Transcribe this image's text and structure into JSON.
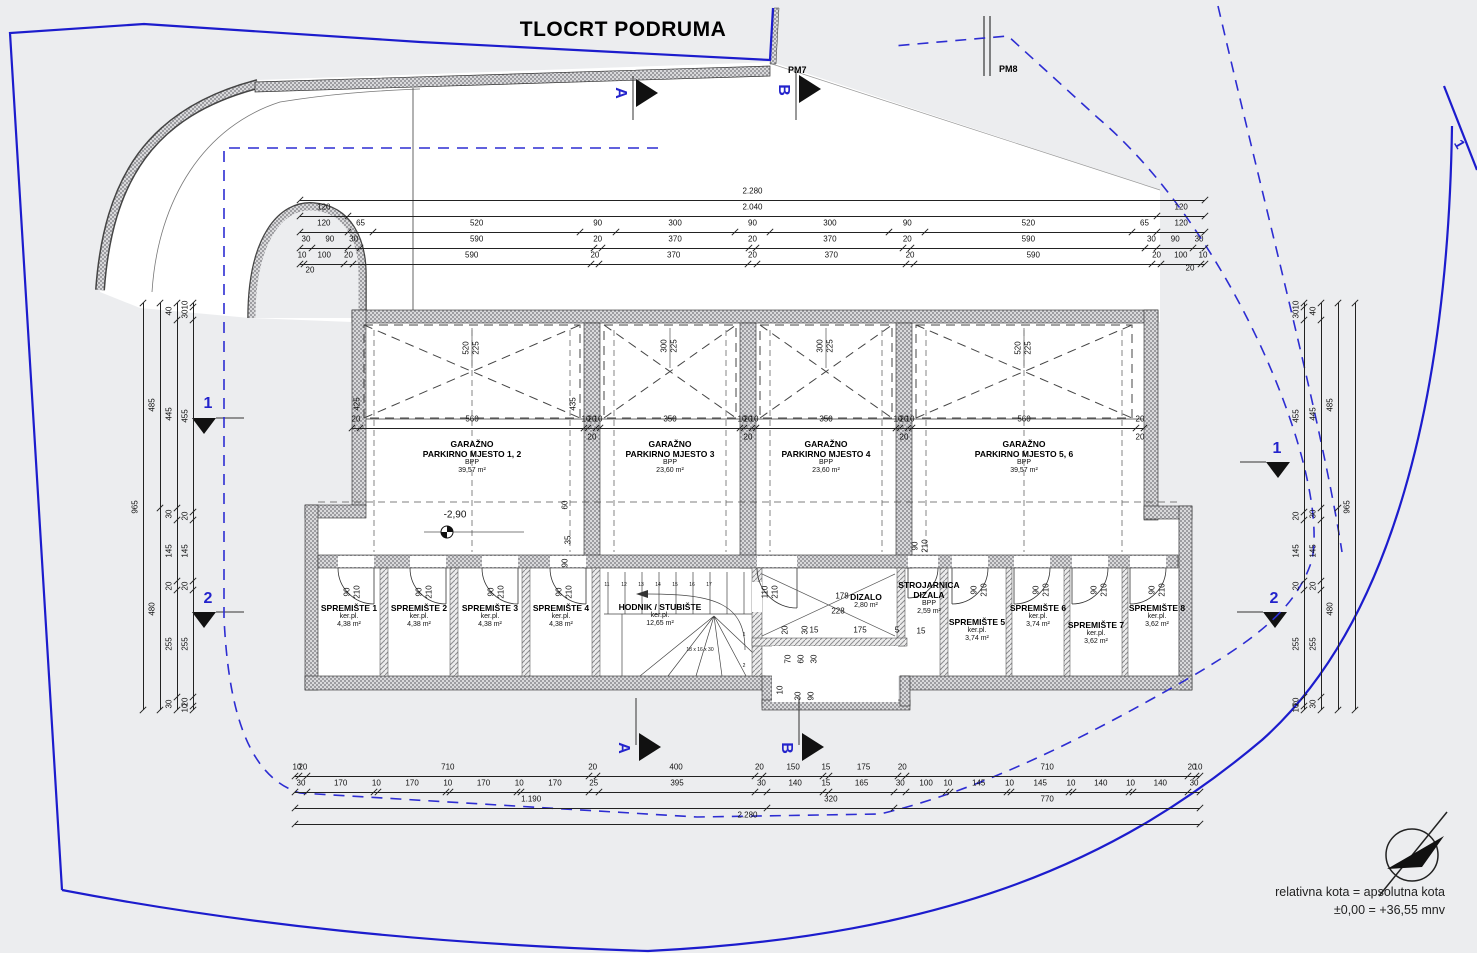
{
  "title": "TLOCRT PODRUMA",
  "legend": {
    "line1": "relativna kota = apsolutna kota",
    "line2": "±0,00 = +36,55 mnv"
  },
  "labels": {
    "pm7": "PM7",
    "pm8": "PM8",
    "corner_plot": "1"
  },
  "colors": {
    "boundary": "#1c1ccd",
    "setback": "#2d2dd2",
    "bg": "#ecedef",
    "ink": "#1a1a1a"
  },
  "rooms": [
    {
      "id": "garage-1-2",
      "name": "GARAŽNO\nPARKIRNO MJESTO 1, 2",
      "sub1": "BPP",
      "sub2": "39,57 m²",
      "cx": 472,
      "cy": 447
    },
    {
      "id": "garage-3",
      "name": "GARAŽNO\nPARKIRNO MJESTO 3",
      "sub1": "BPP",
      "sub2": "23,60 m²",
      "cx": 670,
      "cy": 447
    },
    {
      "id": "garage-4",
      "name": "GARAŽNO\nPARKIRNO MJESTO 4",
      "sub1": "BPP",
      "sub2": "23,60 m²",
      "cx": 826,
      "cy": 447
    },
    {
      "id": "garage-5-6",
      "name": "GARAŽNO\nPARKIRNO MJESTO 5, 6",
      "sub1": "BPP",
      "sub2": "39,57 m²",
      "cx": 1024,
      "cy": 447
    },
    {
      "id": "spremiste-1",
      "name": "SPREMIŠTE 1",
      "sub1": "ker.pl.",
      "sub2": "4,38 m²",
      "cx": 349,
      "cy": 611
    },
    {
      "id": "spremiste-2",
      "name": "SPREMIŠTE 2",
      "sub1": "ker.pl.",
      "sub2": "4,38 m²",
      "cx": 419,
      "cy": 611
    },
    {
      "id": "spremiste-3",
      "name": "SPREMIŠTE 3",
      "sub1": "ker.pl.",
      "sub2": "4,38 m²",
      "cx": 490,
      "cy": 611
    },
    {
      "id": "spremiste-4",
      "name": "SPREMIŠTE 4",
      "sub1": "ker.pl.",
      "sub2": "4,38 m²",
      "cx": 561,
      "cy": 611
    },
    {
      "id": "hodnik-stubiste",
      "name": "HODNIK / STUBIŠTE",
      "sub1": "ker.pl.",
      "sub2": "12,65 m²",
      "cx": 660,
      "cy": 610
    },
    {
      "id": "dizalo",
      "name": "DIZALO",
      "sub1": "2,80 m²",
      "sub2": "",
      "cx": 866,
      "cy": 600
    },
    {
      "id": "strojarnica-dizala",
      "name": "STROJARNICA\nDIZALA",
      "sub1": "BPP",
      "sub2": "2,59 m²",
      "cx": 929,
      "cy": 588
    },
    {
      "id": "spremiste-5",
      "name": "SPREMIŠTE 5",
      "sub1": "ker.pl.",
      "sub2": "3,74 m²",
      "cx": 977,
      "cy": 625
    },
    {
      "id": "spremiste-6",
      "name": "SPREMIŠTE 6",
      "sub1": "ker.pl.",
      "sub2": "3,74 m²",
      "cx": 1038,
      "cy": 611
    },
    {
      "id": "spremiste-7",
      "name": "SPREMIŠTE 7",
      "sub1": "ker.pl.",
      "sub2": "3,62 m²",
      "cx": 1096,
      "cy": 628
    },
    {
      "id": "spremiste-8",
      "name": "SPREMIŠTE 8",
      "sub1": "ker.pl.",
      "sub2": "3,62 m²",
      "cx": 1157,
      "cy": 611
    }
  ],
  "dims": {
    "chains": [
      {
        "id": "top-1",
        "o": "h",
        "x": 300,
        "y": 192,
        "len": 905,
        "vals": [
          "2.280"
        ]
      },
      {
        "id": "top-2",
        "o": "h",
        "x": 300,
        "y": 208,
        "len": 905,
        "vals": [
          "120",
          "2.040",
          "120"
        ]
      },
      {
        "id": "top-3",
        "o": "h",
        "x": 300,
        "y": 224,
        "len": 905,
        "vals": [
          "120",
          "65",
          "520",
          "90",
          "300",
          "90",
          "300",
          "90",
          "520",
          "65",
          "120"
        ]
      },
      {
        "id": "top-4",
        "o": "h",
        "x": 300,
        "y": 240,
        "len": 905,
        "vals": [
          "30",
          "90",
          "30",
          "590",
          "20",
          "370",
          "20",
          "370",
          "20",
          "590",
          "30",
          "90",
          "30"
        ]
      },
      {
        "id": "top-5",
        "o": "h",
        "x": 300,
        "y": 256,
        "len": 905,
        "vals": [
          "10",
          "100",
          "20",
          "590",
          "20",
          "370",
          "20",
          "370",
          "20",
          "590",
          "20",
          "100",
          "10"
        ]
      },
      {
        "id": "garage-front",
        "o": "h",
        "x": 352,
        "y": 420,
        "len": 792,
        "vals": [
          "20",
          "560",
          "10",
          "20",
          "10",
          "350",
          "10",
          "20",
          "10",
          "350",
          "10",
          "20",
          "10",
          "560",
          "20"
        ]
      },
      {
        "id": "bottom-1",
        "o": "h",
        "x": 295,
        "y": 768,
        "len": 905,
        "vals": [
          "10",
          "20",
          "710",
          "20",
          "400",
          "20",
          "150",
          "15",
          "175",
          "20",
          "710",
          "20",
          "10"
        ]
      },
      {
        "id": "bottom-2",
        "o": "h",
        "x": 295,
        "y": 784,
        "len": 905,
        "vals": [
          "30",
          "170",
          "10",
          "170",
          "10",
          "170",
          "10",
          "170",
          "25",
          "395",
          "30",
          "140",
          "15",
          "165",
          "30",
          "100",
          "10",
          "145",
          "10",
          "145",
          "10",
          "140",
          "10",
          "140",
          "30"
        ]
      },
      {
        "id": "bottom-3",
        "o": "h",
        "x": 295,
        "y": 800,
        "len": 905,
        "vals": [
          "1.190",
          "320",
          "770"
        ]
      },
      {
        "id": "bottom-4",
        "o": "h",
        "x": 295,
        "y": 816,
        "len": 905,
        "vals": [
          "2.280"
        ]
      },
      {
        "id": "left-1",
        "o": "v",
        "x": 143,
        "y": 303,
        "len": 407,
        "vals": [
          "965"
        ]
      },
      {
        "id": "left-2",
        "o": "v",
        "x": 160,
        "y": 303,
        "len": 407,
        "vals": [
          "485",
          "480"
        ]
      },
      {
        "id": "left-3",
        "o": "v",
        "x": 177,
        "y": 303,
        "len": 407,
        "vals": [
          "40",
          "445",
          "30",
          "145",
          "20",
          "255",
          "30"
        ]
      },
      {
        "id": "left-4",
        "o": "v",
        "x": 193,
        "y": 303,
        "len": 407,
        "vals": [
          "10",
          "30",
          "455",
          "20",
          "145",
          "20",
          "255",
          "20",
          "10"
        ]
      },
      {
        "id": "right-1",
        "o": "v",
        "x": 1304,
        "y": 303,
        "len": 407,
        "vals": [
          "10",
          "30",
          "455",
          "20",
          "145",
          "20",
          "255",
          "20",
          "10"
        ]
      },
      {
        "id": "right-2",
        "o": "v",
        "x": 1321,
        "y": 303,
        "len": 407,
        "vals": [
          "40",
          "445",
          "30",
          "145",
          "20",
          "255",
          "30"
        ]
      },
      {
        "id": "right-3",
        "o": "v",
        "x": 1338,
        "y": 303,
        "len": 407,
        "vals": [
          "485",
          "480"
        ]
      },
      {
        "id": "right-4",
        "o": "v",
        "x": 1355,
        "y": 303,
        "len": 407,
        "vals": [
          "965"
        ]
      }
    ]
  },
  "annotations": [
    {
      "t": "520",
      "x": 467,
      "y": 348,
      "r": -90
    },
    {
      "t": "225",
      "x": 477,
      "y": 348,
      "r": -90
    },
    {
      "t": "300",
      "x": 665,
      "y": 346,
      "r": -90
    },
    {
      "t": "225",
      "x": 675,
      "y": 346,
      "r": -90
    },
    {
      "t": "300",
      "x": 821,
      "y": 346,
      "r": -90
    },
    {
      "t": "225",
      "x": 831,
      "y": 346,
      "r": -90
    },
    {
      "t": "520",
      "x": 1019,
      "y": 348,
      "r": -90
    },
    {
      "t": "225",
      "x": 1029,
      "y": 348,
      "r": -90
    },
    {
      "t": "425",
      "x": 358,
      "y": 404,
      "r": -90
    },
    {
      "t": "435",
      "x": 574,
      "y": 404,
      "r": -90
    },
    {
      "t": "20",
      "x": 592,
      "y": 438
    },
    {
      "t": "20",
      "x": 748,
      "y": 438
    },
    {
      "t": "20",
      "x": 904,
      "y": 438
    },
    {
      "t": "20",
      "x": 1140,
      "y": 438
    },
    {
      "t": "20",
      "x": 310,
      "y": 271
    },
    {
      "t": "20",
      "x": 1190,
      "y": 269
    },
    {
      "t": "-2,90",
      "x": 455,
      "y": 515,
      "s": 10
    },
    {
      "t": "60",
      "x": 566,
      "y": 505,
      "r": -90
    },
    {
      "t": "35",
      "x": 569,
      "y": 540,
      "r": -90
    },
    {
      "t": "90",
      "x": 566,
      "y": 563,
      "r": -90
    },
    {
      "t": "90",
      "x": 348,
      "y": 592,
      "r": -90
    },
    {
      "t": "210",
      "x": 358,
      "y": 592,
      "r": -90
    },
    {
      "t": "90",
      "x": 420,
      "y": 592,
      "r": -90
    },
    {
      "t": "210",
      "x": 430,
      "y": 592,
      "r": -90
    },
    {
      "t": "90",
      "x": 492,
      "y": 592,
      "r": -90
    },
    {
      "t": "210",
      "x": 502,
      "y": 592,
      "r": -90
    },
    {
      "t": "90",
      "x": 560,
      "y": 592,
      "r": -90
    },
    {
      "t": "210",
      "x": 570,
      "y": 592,
      "r": -90
    },
    {
      "t": "90",
      "x": 975,
      "y": 590,
      "r": -90
    },
    {
      "t": "210",
      "x": 985,
      "y": 590,
      "r": -90
    },
    {
      "t": "90",
      "x": 1037,
      "y": 590,
      "r": -90
    },
    {
      "t": "210",
      "x": 1047,
      "y": 590,
      "r": -90
    },
    {
      "t": "90",
      "x": 1095,
      "y": 590,
      "r": -90
    },
    {
      "t": "210",
      "x": 1105,
      "y": 590,
      "r": -90
    },
    {
      "t": "90",
      "x": 1153,
      "y": 590,
      "r": -90
    },
    {
      "t": "210",
      "x": 1163,
      "y": 590,
      "r": -90
    },
    {
      "t": "90",
      "x": 916,
      "y": 546,
      "r": -90
    },
    {
      "t": "210",
      "x": 926,
      "y": 546,
      "r": -90
    },
    {
      "t": "110",
      "x": 766,
      "y": 592,
      "r": -90
    },
    {
      "t": "210",
      "x": 776,
      "y": 592,
      "r": -90
    },
    {
      "t": "178",
      "x": 842,
      "y": 597
    },
    {
      "t": "228",
      "x": 838,
      "y": 612
    },
    {
      "t": "15",
      "x": 814,
      "y": 631
    },
    {
      "t": "175",
      "x": 860,
      "y": 631
    },
    {
      "t": "5",
      "x": 897,
      "y": 631
    },
    {
      "t": "15",
      "x": 921,
      "y": 632
    },
    {
      "t": "20",
      "x": 786,
      "y": 630,
      "r": -90
    },
    {
      "t": "30",
      "x": 806,
      "y": 630,
      "r": -90
    },
    {
      "t": "70",
      "x": 789,
      "y": 659,
      "r": -90
    },
    {
      "t": "60",
      "x": 802,
      "y": 659,
      "r": -90
    },
    {
      "t": "30",
      "x": 815,
      "y": 659,
      "r": -90
    },
    {
      "t": "10",
      "x": 781,
      "y": 690,
      "r": -90
    },
    {
      "t": "30",
      "x": 799,
      "y": 696,
      "r": -90
    },
    {
      "t": "90",
      "x": 812,
      "y": 696,
      "r": -90
    }
  ],
  "stairs": {
    "numbers": [
      "11",
      "12",
      "13",
      "14",
      "15",
      "16",
      "17"
    ],
    "right": [
      "1",
      "2"
    ],
    "note": "18 x 16 x 30"
  },
  "sections": [
    {
      "t": "A",
      "x": 620,
      "y": 93,
      "r": 90
    },
    {
      "t": "B",
      "x": 783,
      "y": 90,
      "r": 90
    },
    {
      "t": "A",
      "x": 623,
      "y": 748,
      "r": 90
    },
    {
      "t": "B",
      "x": 786,
      "y": 748,
      "r": 90
    },
    {
      "t": "1",
      "x": 208,
      "y": 404,
      "r": 0
    },
    {
      "t": "2",
      "x": 208,
      "y": 599,
      "r": 0
    },
    {
      "t": "1",
      "x": 1277,
      "y": 449,
      "r": 0
    },
    {
      "t": "2",
      "x": 1274,
      "y": 599,
      "r": 0
    }
  ],
  "elevation_mark": "-2,90"
}
